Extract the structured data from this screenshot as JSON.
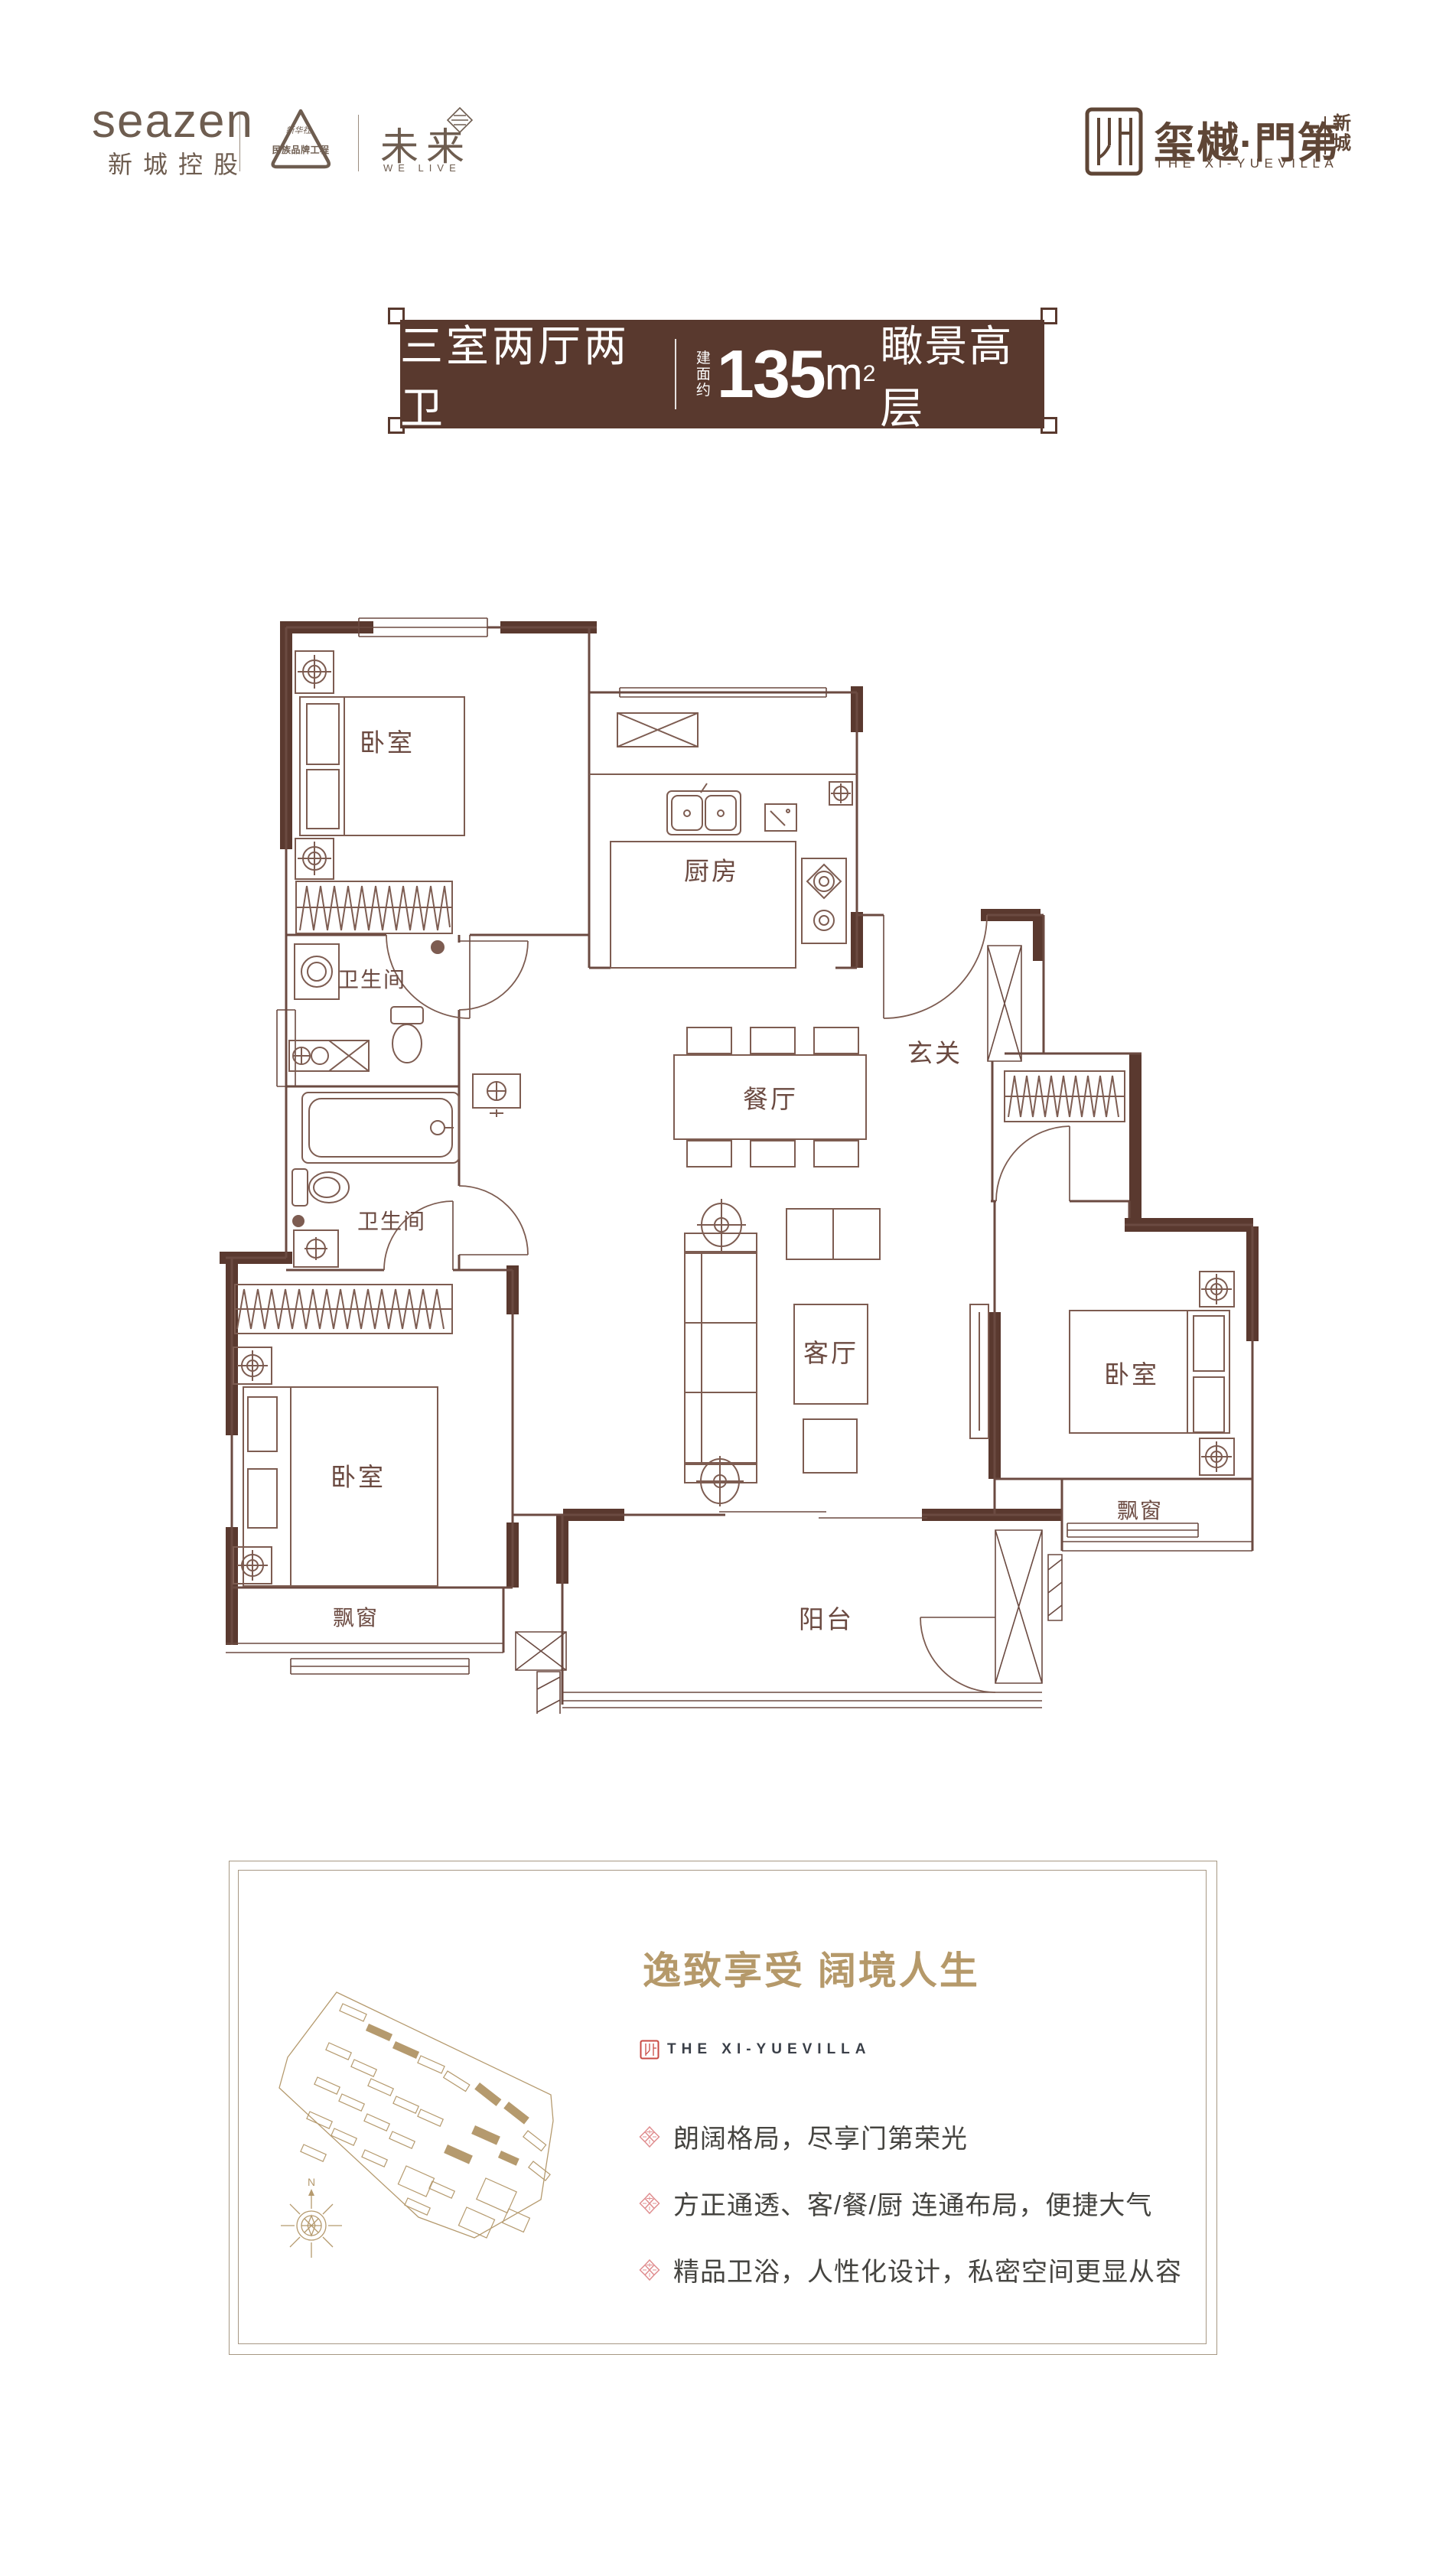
{
  "header": {
    "seazen_en": "seazen",
    "seazen_cn": "新城控股",
    "emblem_script": "新华社",
    "emblem_label": "民族品牌工程",
    "future_cn": "未来",
    "future_en": "WE LIVE",
    "logo_cn": "玺樾·門第",
    "logo_sub": [
      "新",
      "城"
    ],
    "logo_en": "THE XI-YUEVILLA"
  },
  "banner": {
    "layout": "三室两厅两卫",
    "area_prefix": [
      "建",
      "面",
      "约"
    ],
    "area_number": "135",
    "area_unit": "m",
    "area_power": "2",
    "tagline": "瞰景高层"
  },
  "floorplan": {
    "bedroom_tl": "卧室",
    "bedroom_bl": "卧室",
    "bedroom_r": "卧室",
    "kitchen": "厨房",
    "bath_upper": "卫生间",
    "bath_lower": "卫生间",
    "dining": "餐厅",
    "foyer": "玄关",
    "living": "客厅",
    "balcony": "阳台",
    "bay_bl": "飘窗",
    "bay_r": "飘窗"
  },
  "info": {
    "headline": "逸致享受 阔境人生",
    "brand_en": "THE XI-YUEVILLA",
    "bullets": [
      "朗阔格局，尽享门第荣光",
      "方正通透、客/餐/厨 连通布局，便捷大气",
      "精品卫浴，人性化设计，私密空间更显从容"
    ],
    "compass": "N"
  },
  "colors": {
    "banner_brown": "#59392e",
    "wall_brown": "#5a392f",
    "line_brown": "#6b4a41",
    "gold": "#b5996a",
    "pink": "#e08e90",
    "header_brown": "#6e5d50",
    "logo_brown": "#5f4636",
    "body_text": "#454440"
  }
}
